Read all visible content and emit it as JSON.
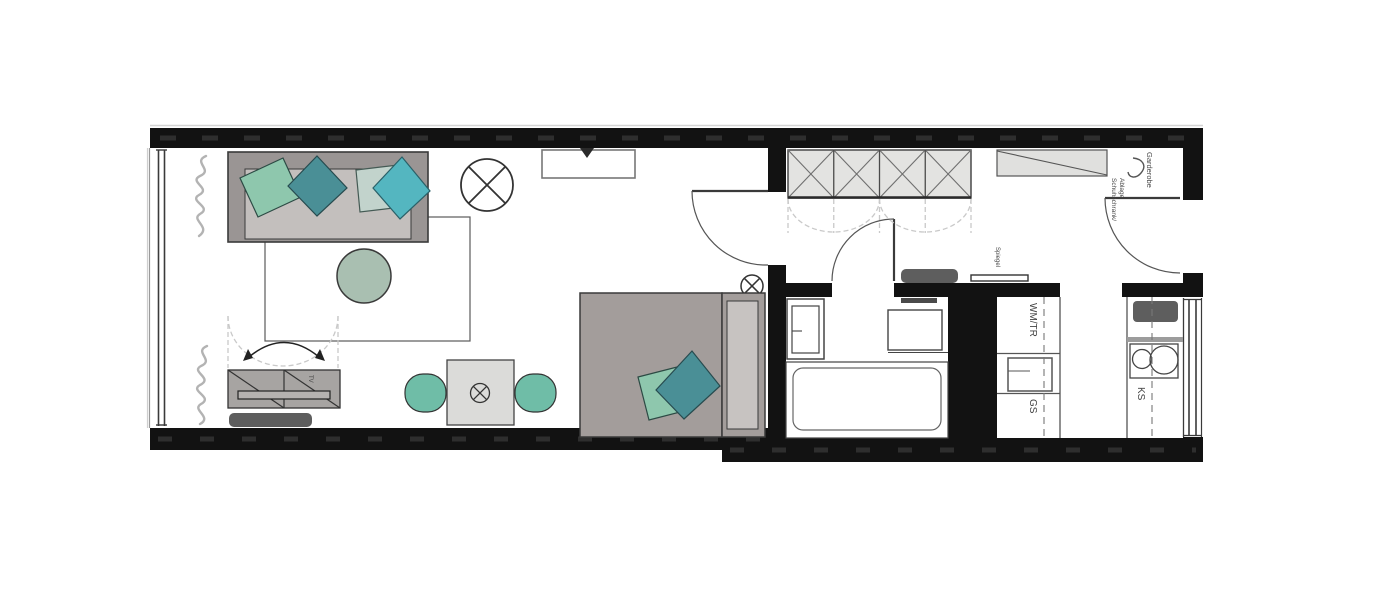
{
  "plan": {
    "labels": {
      "tv": "TV",
      "schuhschrank_line1": "Schuhschrank/",
      "schuhschrank_line2": "Ablage",
      "garderobe": "Garderobe",
      "spiegel": "Spiegel",
      "wm_tr": "WM/TR",
      "gs": "GS",
      "ks": "KS"
    },
    "colors": {
      "wall": "#121212",
      "wall_dash": "#2e2e2e",
      "teal_light": "#8ec7ad",
      "teal_dark": "#4a8f96",
      "teal_pale": "#c2d3cc",
      "teal_bright": "#54b6c0",
      "chair_teal": "#6fbda7",
      "table_sage": "#a9bfb1",
      "sofa_frame": "#9a9594",
      "sofa_seat": "#c3bfbd",
      "bed_gray": "#a39d9b",
      "bed_panel": "#c7c3c1",
      "cabinet_gray": "#a7a4a2",
      "dark_item": "#5e5e5e",
      "wardrobe_fill": "#e3e3e1",
      "shelf_fill": "#e0e0de",
      "dining_table": "#dbdbd9",
      "dash_line": "#c9c9c9",
      "curtain": "#b3b3b3"
    }
  }
}
